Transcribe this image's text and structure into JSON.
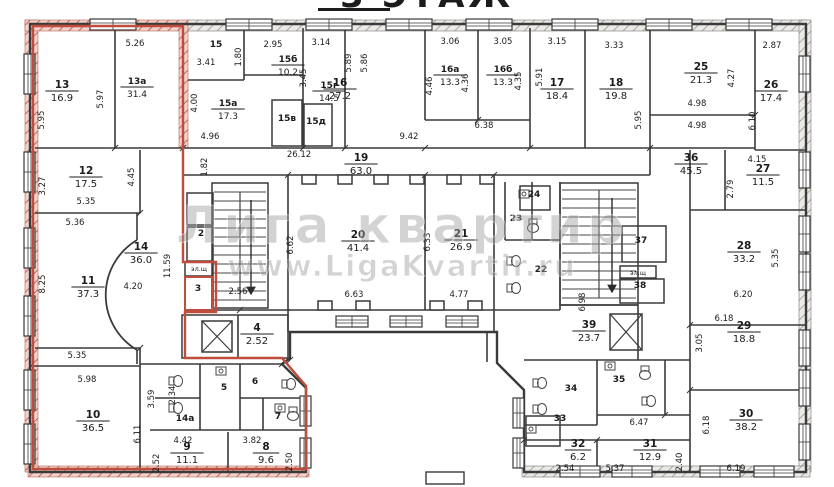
{
  "meta": {
    "type": "apartment-floor-plan",
    "floor_label": "3 ЭТАЖ"
  },
  "title": {
    "number": "3",
    "word": "ЭТАЖ"
  },
  "watermark": {
    "line1": "Лига квартир",
    "line2": "www.LigaKvartir.ru"
  },
  "electrical_label": "эл.щ",
  "colors": {
    "wall": "#3a3a3a",
    "red_outline": "#bf4d3d",
    "red_wall_fill": "#f3d2cb",
    "red_wall_hatch": "#c2695c",
    "gray_wall_fill": "#eceae6",
    "gray_wall_hatch": "#9a978f",
    "paper": "#ffffff",
    "watermark": "#9e9e9e",
    "text": "#1c1c1c"
  },
  "rooms": [
    {
      "n": "13",
      "a": "16.9"
    },
    {
      "n": "13а",
      "a": "31.4"
    },
    {
      "n": "12",
      "a": "17.5"
    },
    {
      "n": "11",
      "a": "37.3"
    },
    {
      "n": "14",
      "a": "36.0"
    },
    {
      "n": "10",
      "a": "36.5"
    },
    {
      "n": "9",
      "a": "11.1"
    },
    {
      "n": "8",
      "a": "9.6"
    },
    {
      "n": "14а"
    },
    {
      "n": "5"
    },
    {
      "n": "6"
    },
    {
      "n": "7"
    },
    {
      "n": "2"
    },
    {
      "n": "3"
    },
    {
      "n": "4",
      "a": "2.52"
    },
    {
      "n": "15"
    },
    {
      "n": "15а",
      "a": "17.3"
    },
    {
      "n": "15б",
      "a": "10.2"
    },
    {
      "n": "15в"
    },
    {
      "n": "15г",
      "a": "14.5"
    },
    {
      "n": "15д"
    },
    {
      "n": "16",
      "a": "27.2"
    },
    {
      "n": "16а",
      "a": "13.3"
    },
    {
      "n": "16б",
      "a": "13.3"
    },
    {
      "n": "17",
      "a": "18.4"
    },
    {
      "n": "18",
      "a": "19.8"
    },
    {
      "n": "19",
      "a": "63.0"
    },
    {
      "n": "20",
      "a": "41.4"
    },
    {
      "n": "21",
      "a": "26.9"
    },
    {
      "n": "22"
    },
    {
      "n": "23"
    },
    {
      "n": "24"
    },
    {
      "n": "25",
      "a": "21.3"
    },
    {
      "n": "26",
      "a": "17.4"
    },
    {
      "n": "27",
      "a": "11.5"
    },
    {
      "n": "28",
      "a": "33.2"
    },
    {
      "n": "29",
      "a": "18.8"
    },
    {
      "n": "30",
      "a": "38.2"
    },
    {
      "n": "31",
      "a": "12.9"
    },
    {
      "n": "32",
      "a": "6.2"
    },
    {
      "n": "33"
    },
    {
      "n": "34"
    },
    {
      "n": "35"
    },
    {
      "n": "36",
      "a": "45.5"
    },
    {
      "n": "37"
    },
    {
      "n": "38"
    },
    {
      "n": "39",
      "a": "23.7"
    }
  ],
  "dimensions": [
    "5.26",
    "5.95",
    "5.97",
    "3.41",
    "1.80",
    "4.00",
    "2.95",
    "3.45",
    "3.14",
    "4.96",
    "26.12",
    "1.82",
    "5.89",
    "5.86",
    "3.06",
    "4.46",
    "4.36",
    "3.05",
    "4.35",
    "5.91",
    "6.38",
    "9.42",
    "3.15",
    "3.33",
    "5.95",
    "4.27",
    "4.98",
    "4.98",
    "2.87",
    "6.10",
    "4.15",
    "2.79",
    "3.27",
    "4.45",
    "5.35",
    "5.36",
    "8.25",
    "11.59",
    "4.20",
    "5.35",
    "5.98",
    "6.11",
    "3.59",
    "2.34",
    "2.56",
    "6.62",
    "6.33",
    "6.63",
    "4.77",
    "6.98",
    "6.20",
    "6.18",
    "3.05",
    "5.35",
    "6.18",
    "6.19",
    "6.47",
    "2.54",
    "5.37",
    "2.40",
    "4.42",
    "2.52",
    "3.82",
    "2.50"
  ]
}
